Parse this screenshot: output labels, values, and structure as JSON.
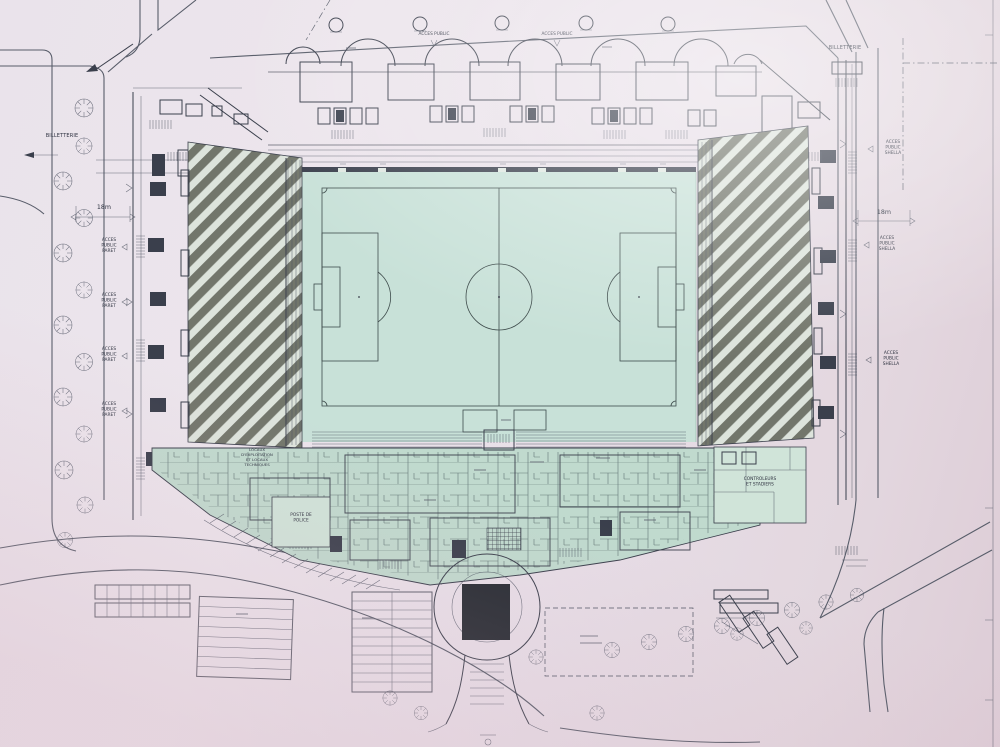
{
  "photo": {
    "paper_color": "#e8e1e9",
    "ink_color": "#3a3f4d",
    "pitch_color": "#c6e2d8",
    "building_tint": "#bedbce",
    "hatch_color": "#63665a",
    "dark_block_color": "#262b33"
  },
  "labels": {
    "billetterie_left": "BILLETTERIE",
    "billetterie_right": "BILLETTERIE",
    "dim_left": "18m",
    "dim_right": "18m",
    "acces_paret": [
      "ACCES",
      "PUBLIC",
      "PARET"
    ],
    "acces_shella": [
      "ACCES",
      "PUBLIC",
      "SHELLA"
    ],
    "acces_top": "ACCES PUBLIC",
    "poste_police": [
      "POSTE DE",
      "POLICE"
    ],
    "controleurs": [
      "CONTROLEURS",
      "ET STADIERS"
    ],
    "locaux": [
      "LOCAUX",
      "D'EXPLOITATION",
      "ET LOCAUX",
      "TECHNIQUES"
    ]
  }
}
